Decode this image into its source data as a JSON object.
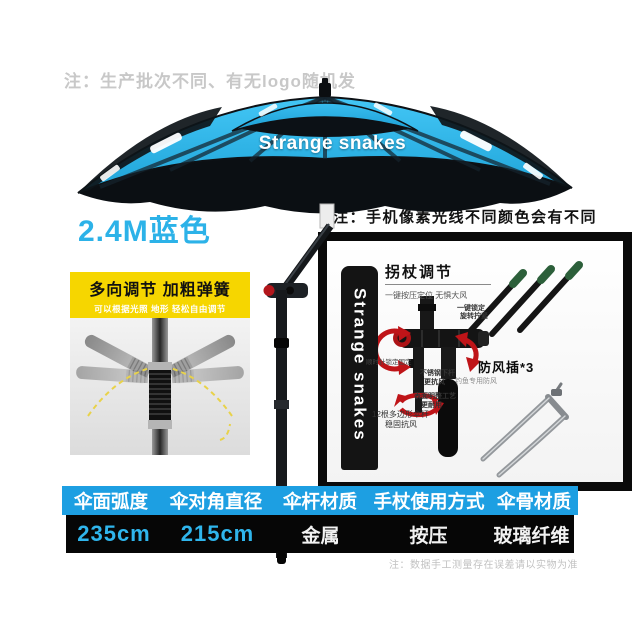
{
  "notes": {
    "production": "注：生产批次不同、有无logo随机发",
    "color": "注：手机像素光线不同颜色会有不同",
    "measurement": "注：数据手工测量存在误差请以实物为准"
  },
  "umbrella": {
    "brand": "Strange snakes",
    "size_label": "2.4M蓝色",
    "canopy_color": "#2bb3e9"
  },
  "spring_inset": {
    "title": "多向调节 加粗弹簧",
    "subtitle": "可以根据光照 地形 轻松自由调节",
    "banner_color": "#f6d600"
  },
  "stand_panel": {
    "bag_brand": "Strange snakes",
    "section_title": "拐杖调节",
    "section_subtitle": "一键按压定位 无惧大风",
    "stake_label": "防风插*3",
    "stake_note_line1": "一键锁定",
    "stake_note_line2": "旋转拧紧",
    "rotate_note": "顺时针锁定固定",
    "pole_note_line1": "12根多边形伞杆",
    "pole_note_line2": "稳固抗风",
    "lower_note_line1": "不锈钢下杆",
    "lower_note_line2": "更抗风",
    "lower_note_line3": "钓鱼专用防风",
    "craft_note_line1": "表面明整工艺",
    "craft_note_line2": "更耐用"
  },
  "spec_table": {
    "header_bg": "#1d9fe2",
    "value_bg": "#060606",
    "accent_text": "#2fb5ec",
    "columns": [
      {
        "header": "伞面弧度",
        "value": "235cm"
      },
      {
        "header": "伞对角直径",
        "value": "215cm"
      },
      {
        "header": "伞杆材质",
        "value": "金属"
      },
      {
        "header": "手杖使用方式",
        "value": "按压"
      },
      {
        "header": "伞骨材质",
        "value": "玻璃纤维"
      }
    ]
  }
}
